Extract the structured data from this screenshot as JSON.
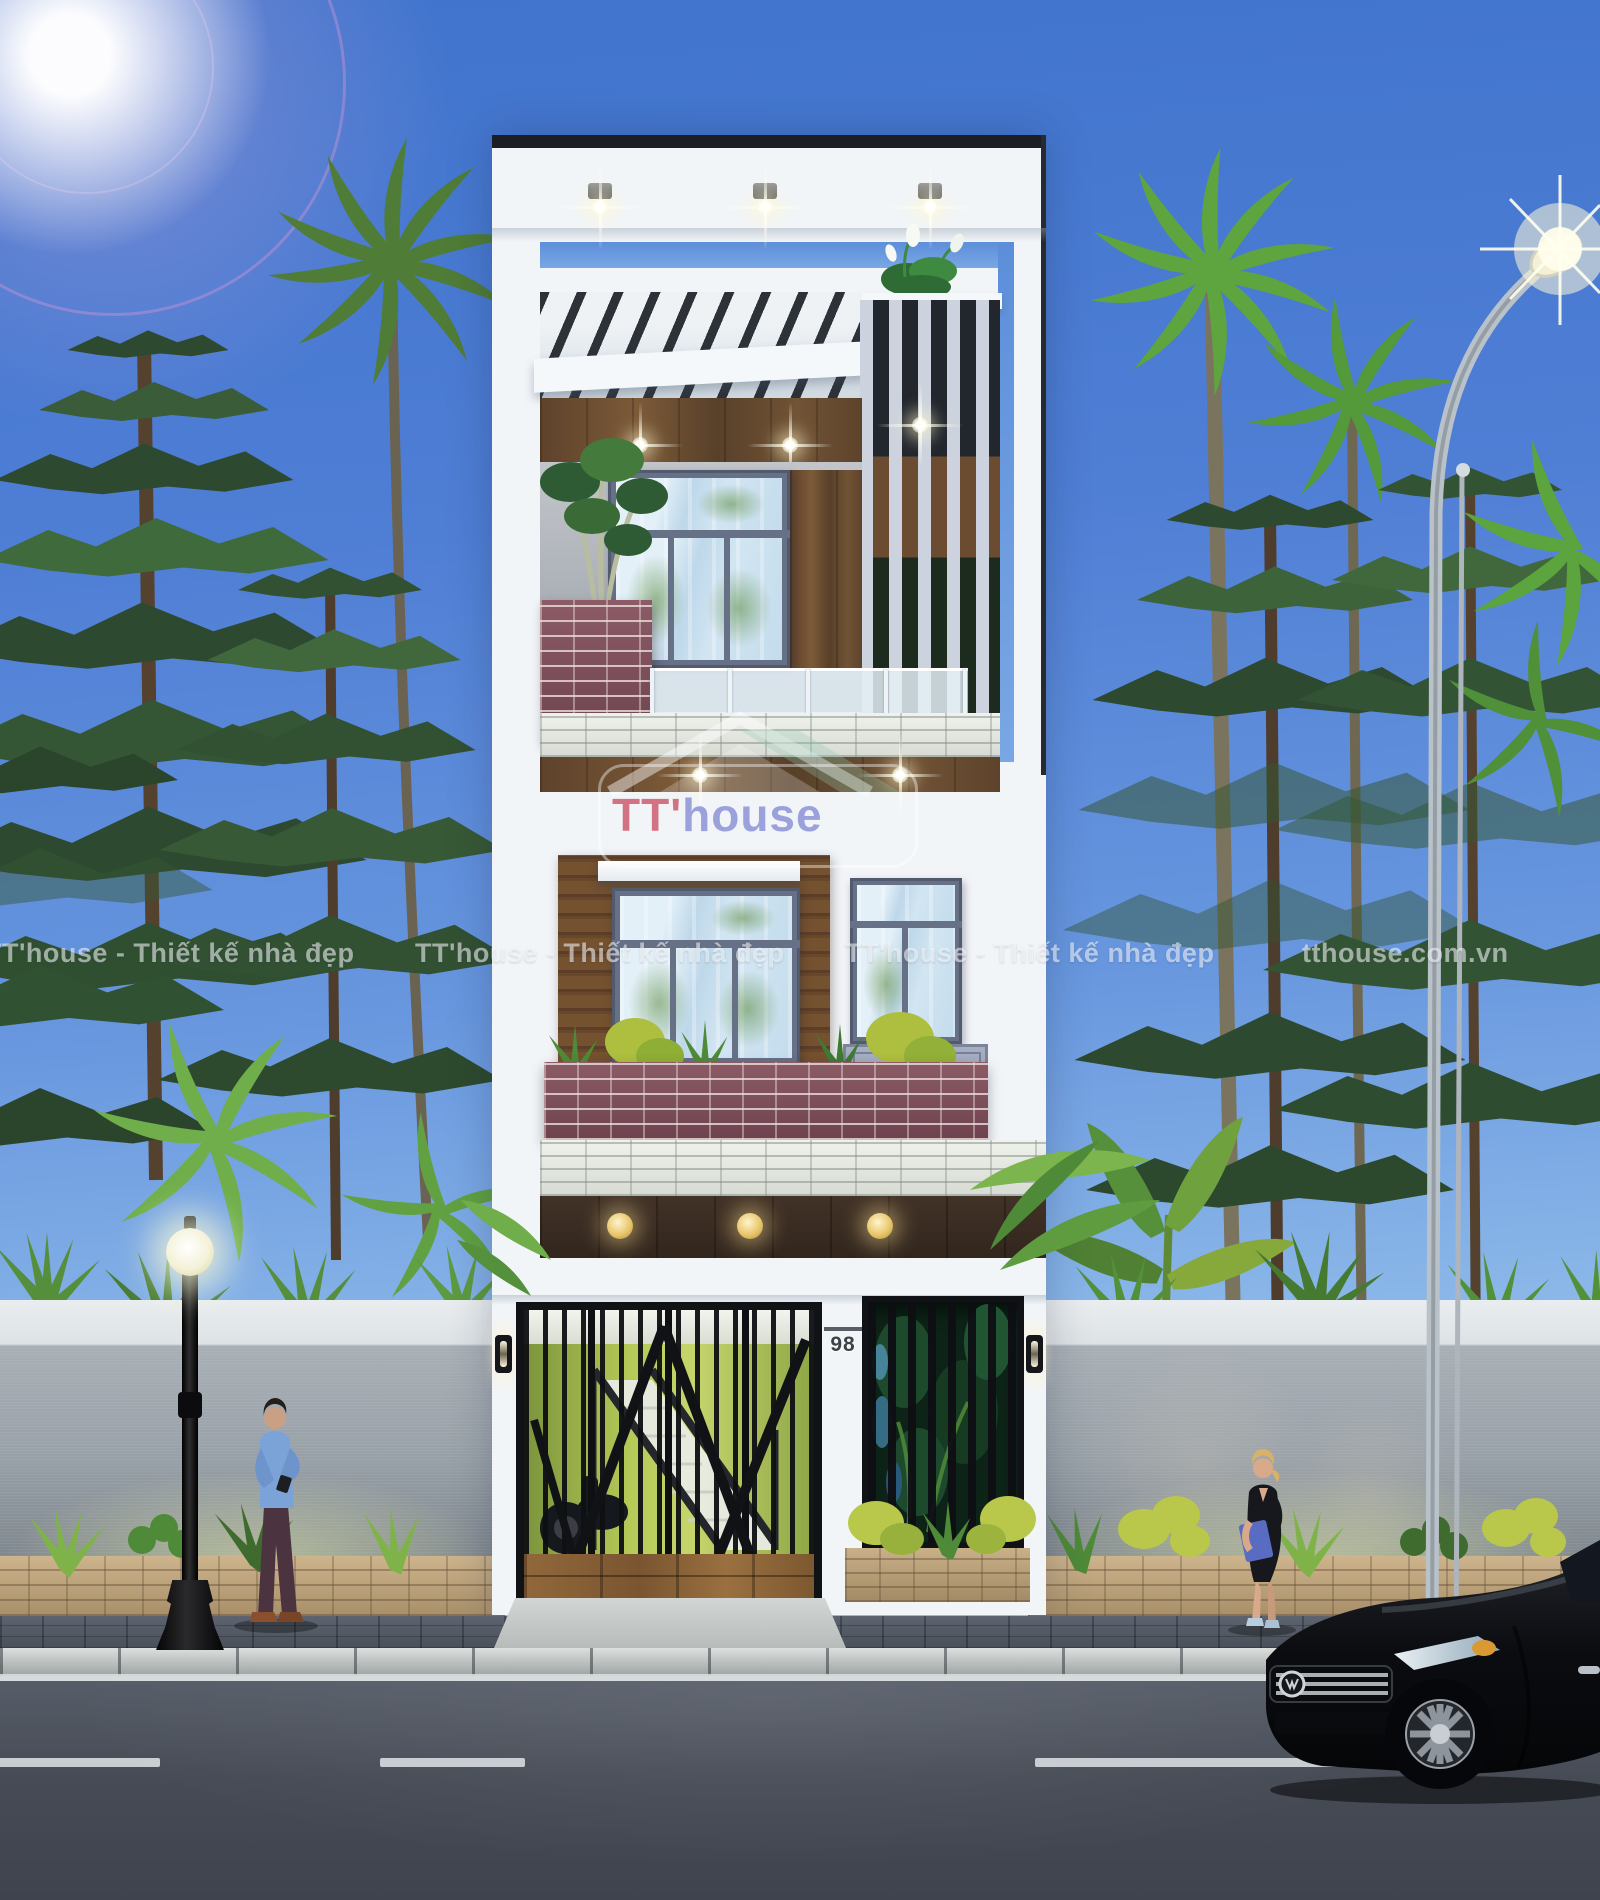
{
  "image": {
    "type": "3d-architectural-render",
    "description": "Street elevation of a modern 4-level white tube house at dusk, flanked by pine and palm trees behind a gray boundary wall, with a classic lamp post, a curved street light, two pedestrians and a black sedan on the road"
  },
  "watermark": {
    "tagline": "TT'house - Thiết kế nhà đẹp",
    "website": "tthouse.com.vn"
  },
  "logo": {
    "prefix": "TT'",
    "suffix": "house"
  },
  "house": {
    "number": "98"
  },
  "colors": {
    "sky_top": "#4074cd",
    "sky_horizon": "#d8e9f6",
    "facade_white": "#f2f5f8",
    "frame_dark": "#1b1e24",
    "wood": "#6d4b30",
    "brick_planter": "#7c4b56",
    "stone_band": "#e7eae4",
    "glass": "#c9def0",
    "gate_metal": "#101216",
    "gate_wood": "#8a6234",
    "interior_glow": "#b6ca57",
    "louver_backdrop": "#0d2317",
    "wall_gray": "#99a1a8",
    "planter_brick": "#c7ae86",
    "sidewalk": "#4e545e",
    "curb": "#c6cbca",
    "road": "#4c515c",
    "foliage_dark": "#2f4a30",
    "foliage_bright": "#6fae4a",
    "car_black": "#0c0d11",
    "warm_light": "#ffe9b0",
    "logo_red": "#cd5c6e",
    "logo_purple": "#8c92d6"
  }
}
